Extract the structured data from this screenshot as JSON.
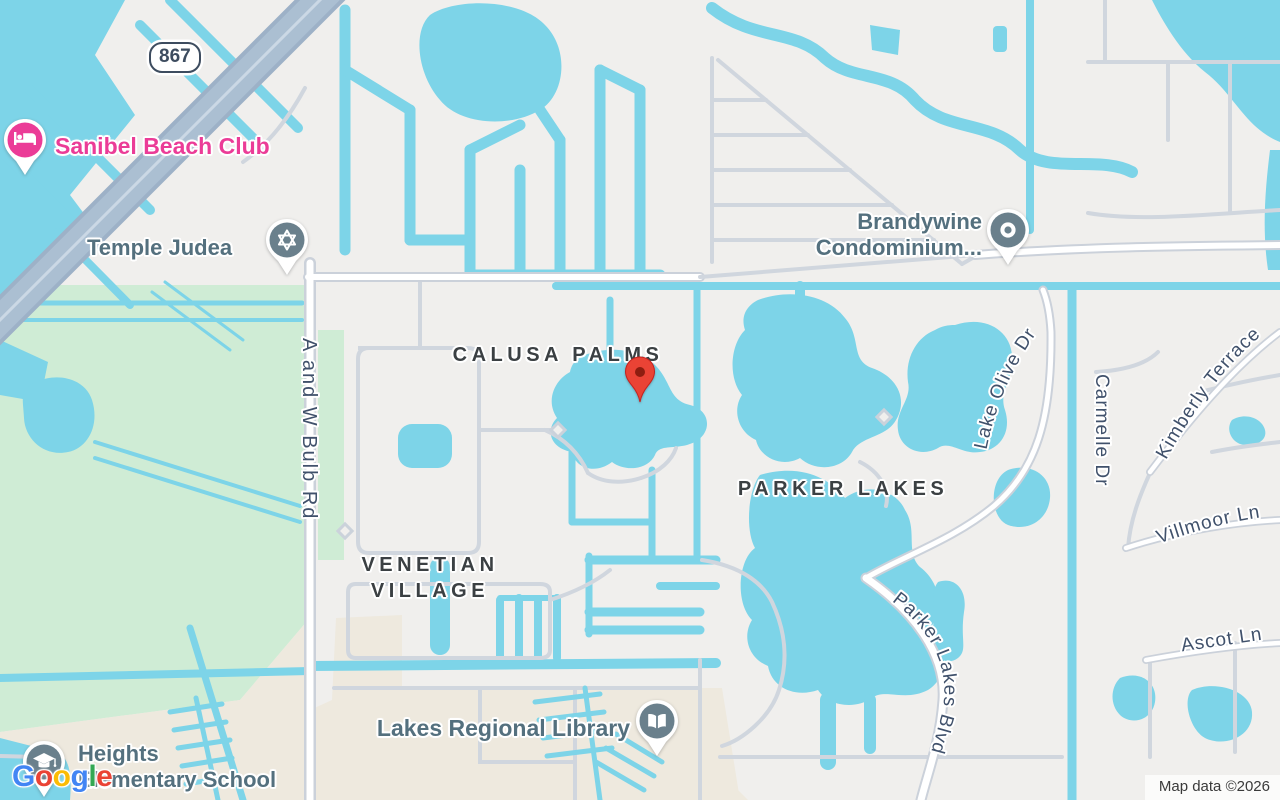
{
  "map": {
    "attribution": "Map data ©2026",
    "route_badge": "867",
    "areas": {
      "calusa_palms": "CALUSA PALMS",
      "parker_lakes": "PARKER LAKES",
      "venetian_village_line1": "VENETIAN",
      "venetian_village_line2": "VILLAGE"
    },
    "pois": {
      "sanibel_beach_club": {
        "label": "Sanibel Beach Club",
        "icon": "bed-icon"
      },
      "temple_judea": {
        "label": "Temple Judea",
        "icon": "star-of-david-icon"
      },
      "brandywine": {
        "line1": "Brandywine",
        "line2": "Condominium...",
        "icon": "circle-dot-icon"
      },
      "lakes_regional_library": {
        "label": "Lakes Regional Library",
        "icon": "open-book-icon"
      },
      "heights_elementary": {
        "line1": "Heights",
        "line2": "Elementary School",
        "icon": "graduation-cap-icon"
      },
      "destination_marker": {
        "icon": "red-map-pin"
      }
    },
    "roads": {
      "a_and_w_bulb_rd": "A and W Bulb Rd",
      "lake_olive_dr": "Lake Olive Dr",
      "carmelle_dr": "Carmelle Dr",
      "kimberly_terrace": "Kimberly Terrace",
      "villmoor_ln": "Villmoor Ln",
      "ascot_ln": "Ascot Ln",
      "parker_lakes_blvd": "Parker Lakes Blvd"
    },
    "colors": {
      "water": "#7DD4E8",
      "land": "#F0EFED",
      "park_green": "#CFECD5",
      "school_grounds": "#EEE9DE",
      "minor_road": "#D0D6DE",
      "highway": "#9DB1C7",
      "poi_pin_slate": "#6A808C",
      "poi_label": "#54707E",
      "hotel_pink": "#EB3C97",
      "marker_red": "#EA4335",
      "road_label": "#40516B",
      "area_label": "#3B4043"
    }
  },
  "google_logo": {
    "letters": [
      {
        "char": "G",
        "color": "#4285F4"
      },
      {
        "char": "o",
        "color": "#EA4335"
      },
      {
        "char": "o",
        "color": "#FBBC05"
      },
      {
        "char": "g",
        "color": "#4285F4"
      },
      {
        "char": "l",
        "color": "#34A853"
      },
      {
        "char": "e",
        "color": "#EA4335"
      }
    ]
  }
}
